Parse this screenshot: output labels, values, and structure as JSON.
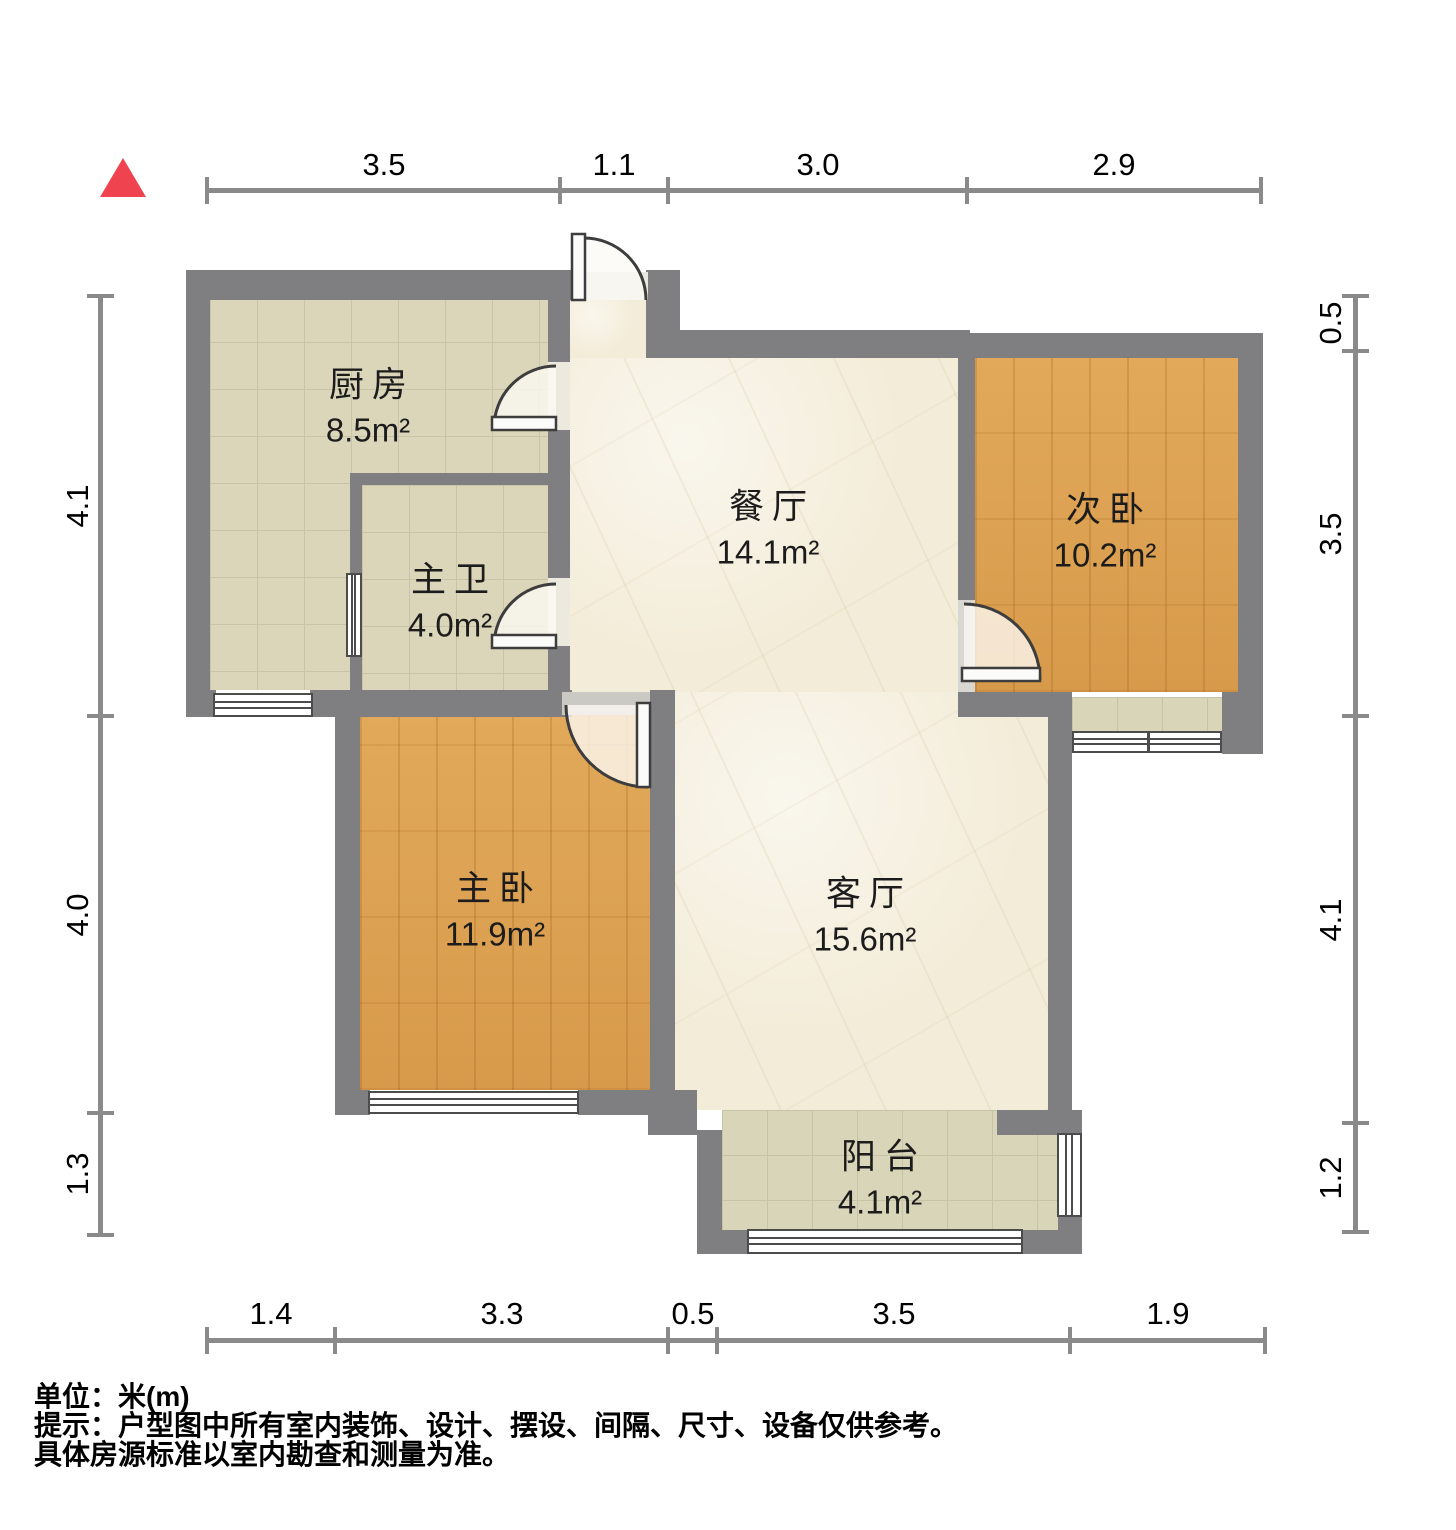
{
  "compass": {
    "shape": "north-arrow",
    "color": "#ef4450"
  },
  "rooms": [
    {
      "id": "kitchen",
      "name": "厨房",
      "area": "8.5m²",
      "floor": "tile"
    },
    {
      "id": "master-bath",
      "name": "主卫",
      "area": "4.0m²",
      "floor": "tile"
    },
    {
      "id": "dining-room",
      "name": "餐厅",
      "area": "14.1m²",
      "floor": "marble"
    },
    {
      "id": "second-bedroom",
      "name": "次卧",
      "area": "10.2m²",
      "floor": "wood"
    },
    {
      "id": "master-bedroom",
      "name": "主卧",
      "area": "11.9m²",
      "floor": "wood"
    },
    {
      "id": "living-room",
      "name": "客厅",
      "area": "15.6m²",
      "floor": "marble"
    },
    {
      "id": "balcony",
      "name": "阳台",
      "area": "4.1m²",
      "floor": "tile"
    }
  ],
  "dimensions": {
    "top": [
      "3.5",
      "1.1",
      "3.0",
      "2.9"
    ],
    "bottom": [
      "1.4",
      "3.3",
      "0.5",
      "3.5",
      "1.9"
    ],
    "left": [
      "4.1",
      "4.0",
      "1.3"
    ],
    "right": [
      "0.5",
      "3.5",
      "4.1",
      "1.2"
    ]
  },
  "notes": {
    "unit": "单位：米(m)",
    "tip1": "提示：户型图中所有室内装饰、设计、摆设、间隔、尺寸、设备仅供参考。",
    "tip2": "具体房源标准以室内勘查和测量为准。"
  },
  "colors": {
    "wall": "#7f7f81",
    "wood_floor": "#dda04f",
    "tile_floor": "#dbd6ba",
    "balcony_tile": "#d8d5b9",
    "marble_floor": "#f3ecd8",
    "north_arrow": "#ef4450",
    "dim_line": "#8a8a8a",
    "text": "#000000"
  }
}
